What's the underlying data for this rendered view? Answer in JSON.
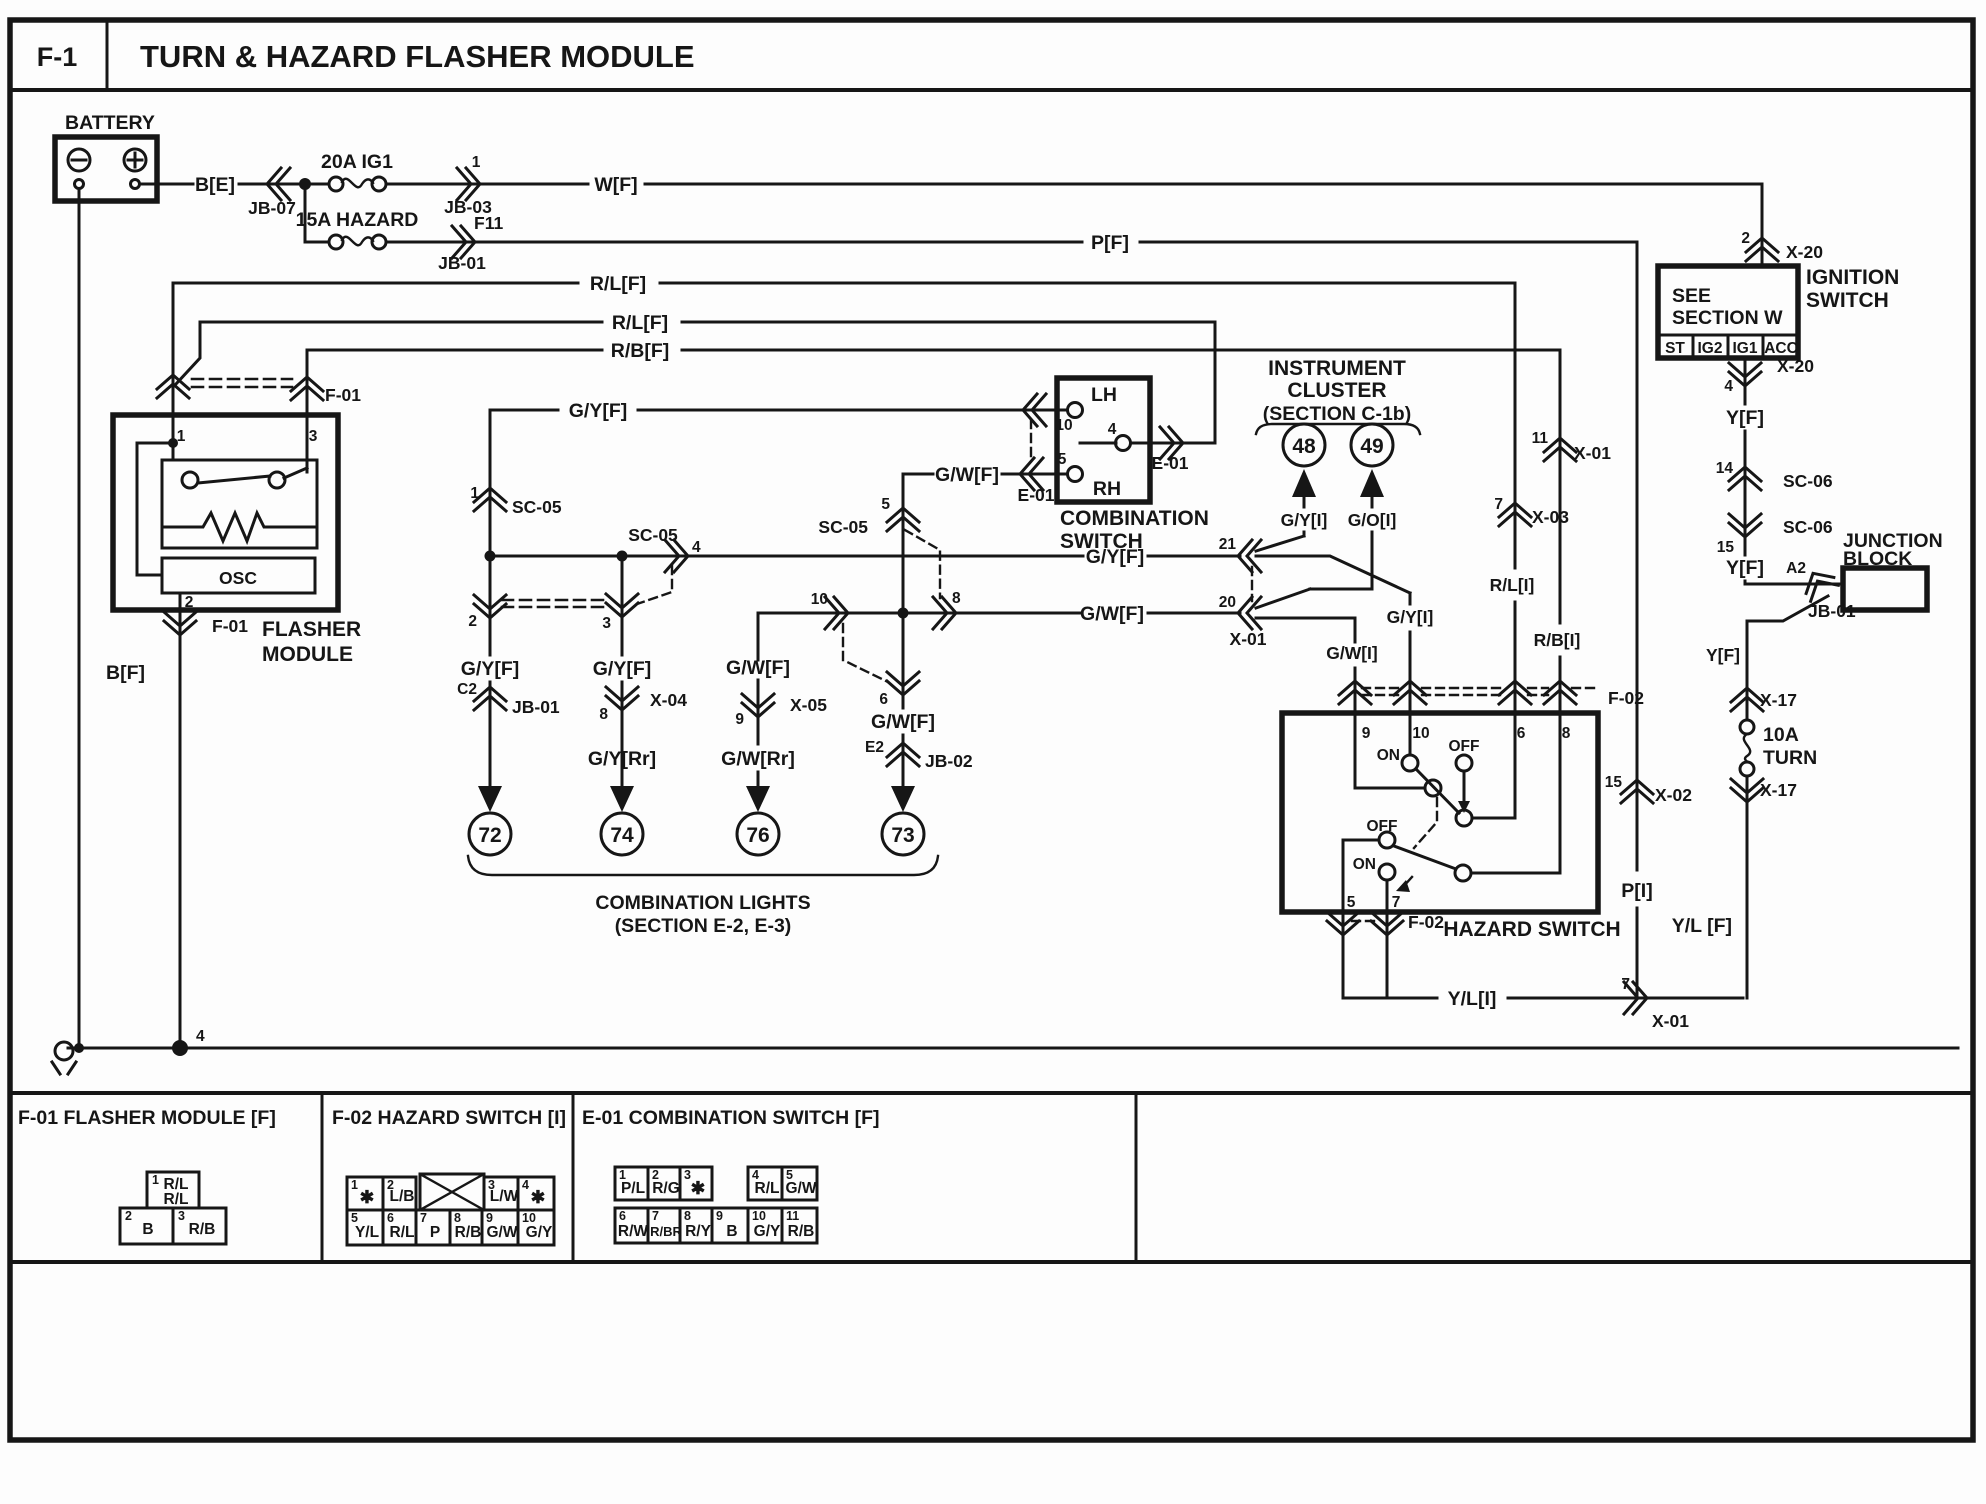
{
  "title": {
    "code": "F-1",
    "text": "TURN & HAZARD FLASHER MODULE"
  },
  "colors": {
    "ink": "#161616",
    "paper": "#fdfdfd"
  },
  "t": {
    "title_code": "F-1",
    "title_text": "TURN & HAZARD FLASHER MODULE",
    "battery": "BATTERY",
    "be": "B[E]",
    "wf": "W[F]",
    "pf": "P[F]",
    "rlf": "R/L[F]",
    "rbf": "R/B[F]",
    "gyf": "G/Y[F]",
    "gwf": "G/W[F]",
    "gyrr": "G/Y[Rr]",
    "gwrr": "G/W[Rr]",
    "gyi": "G/Y[I]",
    "goi": "G/O[I]",
    "gwi": "G/W[I]",
    "rli": "R/L[I]",
    "rbi": "R/B[I]",
    "pi": "P[I]",
    "yf": "Y[F]",
    "ylf": "Y/L [F]",
    "yli": "Y/L[I]",
    "bf": "B[F]",
    "f20a": "20A IG1",
    "f15a": "15A HAZARD",
    "f10a": "10A",
    "turn": "TURN",
    "jb01": "JB-01",
    "jb02": "JB-02",
    "jb03": "JB-03",
    "jb07": "JB-07",
    "f11": "F11",
    "c2": "C2",
    "e2": "E2",
    "a2": "A2",
    "sc05": "SC-05",
    "sc06": "SC-06",
    "x01": "X-01",
    "x02": "X-02",
    "x03": "X-03",
    "x04": "X-04",
    "x05": "X-05",
    "x17": "X-17",
    "x20": "X-20",
    "f01": "F-01",
    "f02": "F-02",
    "e01": "E-01",
    "flasher": "FLASHER",
    "module": "MODULE",
    "osc": "OSC",
    "lh": "LH",
    "rh": "RH",
    "comb1": "COMBINATION",
    "sw": "SWITCH",
    "instr": "INSTRUMENT",
    "cluster": "CLUSTER",
    "secc1b": "(SECTION C-1b)",
    "ign": "IGNITION",
    "see": "SEE",
    "secw": "SECTION W",
    "st": "ST",
    "ig2": "IG2",
    "ig1": "IG1",
    "acc": "ACC",
    "junction": "JUNCTION",
    "block": "BLOCK",
    "hazsw": "HAZARD SWITCH",
    "on": "ON",
    "off": "OFF",
    "lights": "COMBINATION LIGHTS",
    "sece23": "(SECTION E-2, E-3)",
    "th1": "F-01 FLASHER MODULE [F]",
    "th2": "F-02 HAZARD SWITCH [I]",
    "th3": "E-01 COMBINATION SWITCH [F]",
    "rl": "R/L",
    "rb": "R/B",
    "b": "B",
    "star": "✱",
    "lb": "L/B",
    "lw": "L/W",
    "yl": "Y/L",
    "p": "P",
    "gw": "G/W",
    "gy": "G/Y",
    "pl": "P/L",
    "rg": "R/G",
    "rw": "R/W",
    "rbr": "R/BR",
    "ry": "R/Y",
    "n1": "1",
    "n2": "2",
    "n3": "3",
    "n4": "4",
    "n5": "5",
    "n6": "6",
    "n7": "7",
    "n8": "8",
    "n9": "9",
    "n10": "10",
    "n11": "11",
    "n14": "14",
    "n15": "15",
    "n20": "20",
    "n21": "21",
    "n48": "48",
    "n49": "49",
    "n72": "72",
    "n73": "73",
    "n74": "74",
    "n76": "76"
  },
  "connectors": [
    {
      "id": "F-01",
      "pins": [
        {
          "pin": "1",
          "wire": "R/L R/L"
        },
        {
          "pin": "2",
          "wire": "B"
        },
        {
          "pin": "3",
          "wire": "R/B"
        }
      ]
    },
    {
      "id": "F-02",
      "pins": [
        {
          "pin": "1",
          "wire": "✱"
        },
        {
          "pin": "2",
          "wire": "L/B"
        },
        {
          "pin": "3",
          "wire": "L/W"
        },
        {
          "pin": "4",
          "wire": "✱"
        },
        {
          "pin": "5",
          "wire": "Y/L"
        },
        {
          "pin": "6",
          "wire": "R/L"
        },
        {
          "pin": "7",
          "wire": "P"
        },
        {
          "pin": "8",
          "wire": "R/B"
        },
        {
          "pin": "9",
          "wire": "G/W"
        },
        {
          "pin": "10",
          "wire": "G/Y"
        }
      ]
    },
    {
      "id": "E-01",
      "pins": [
        {
          "pin": "1",
          "wire": "P/L"
        },
        {
          "pin": "2",
          "wire": "R/G"
        },
        {
          "pin": "3",
          "wire": "✱"
        },
        {
          "pin": "4",
          "wire": "R/L"
        },
        {
          "pin": "5",
          "wire": "G/W"
        },
        {
          "pin": "6",
          "wire": "R/W"
        },
        {
          "pin": "7",
          "wire": "R/BR"
        },
        {
          "pin": "8",
          "wire": "R/Y"
        },
        {
          "pin": "9",
          "wire": "B"
        },
        {
          "pin": "10",
          "wire": "G/Y"
        },
        {
          "pin": "11",
          "wire": "R/B"
        }
      ]
    }
  ]
}
